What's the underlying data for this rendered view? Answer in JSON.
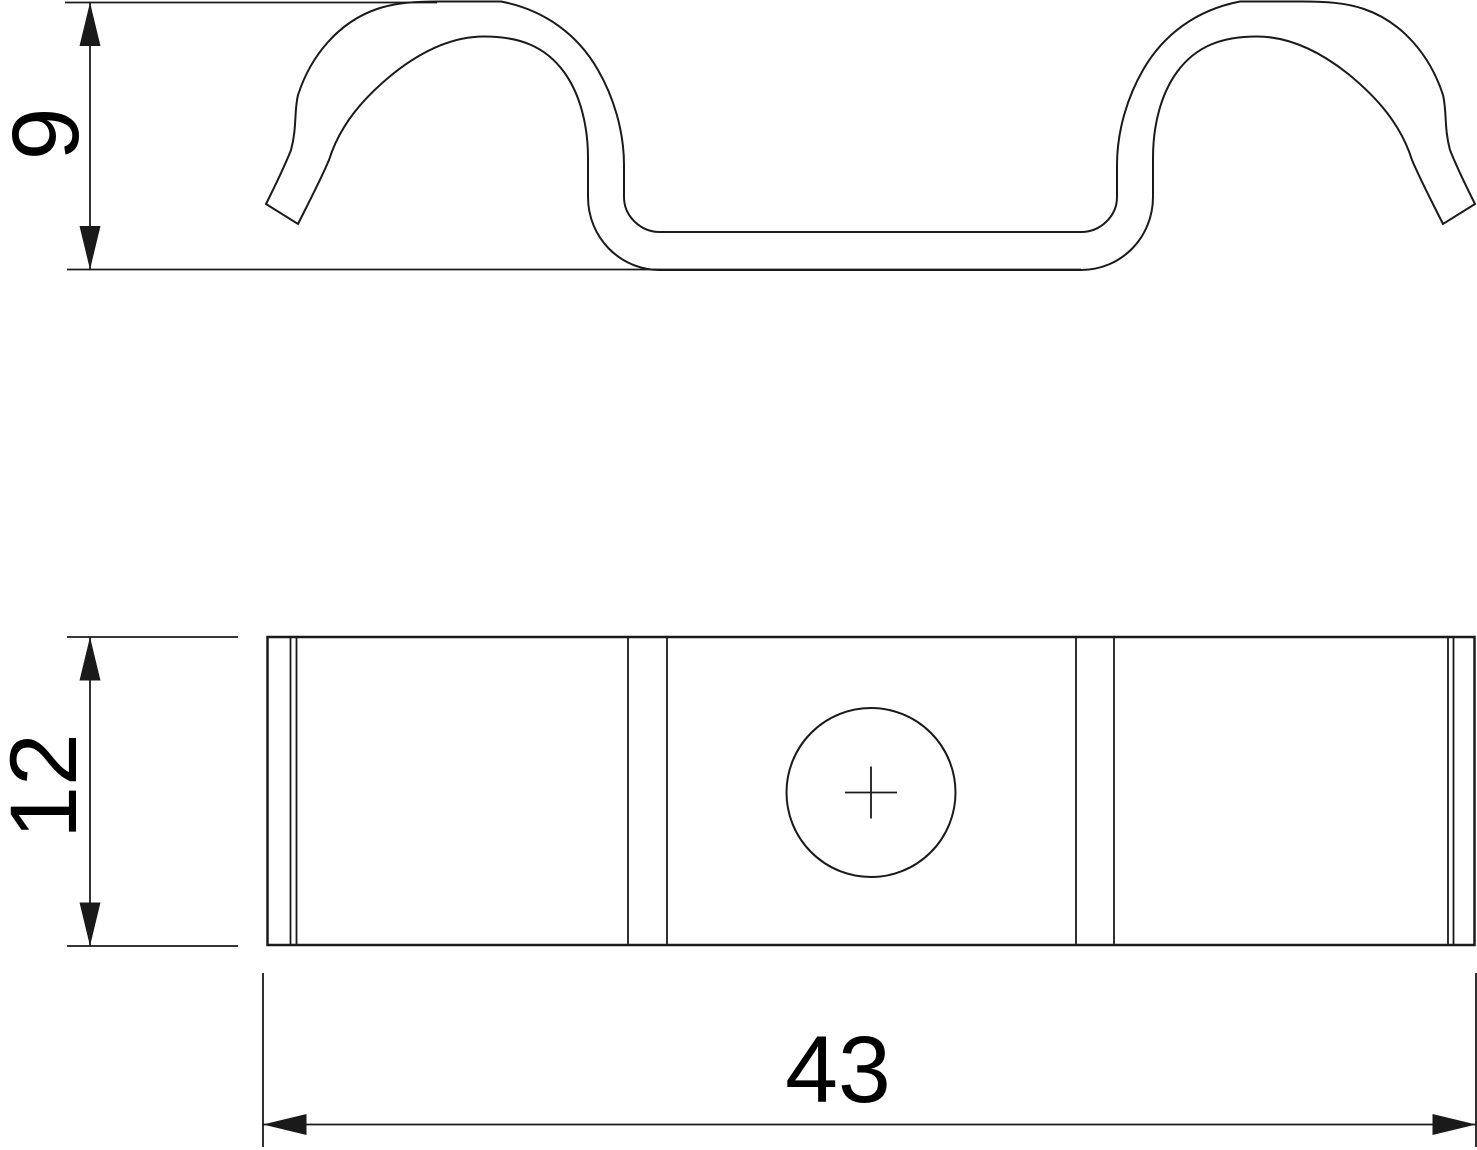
{
  "drawing": {
    "type": "technical-drawing-two-views",
    "colors": {
      "background": "#ffffff",
      "line": "#1a1a1a",
      "text": "#000000"
    },
    "side_view": {
      "description": "side profile of double-hump spring clip",
      "height_dim": {
        "value": "9"
      }
    },
    "plan_view": {
      "description": "plan view of clip plate with center hole",
      "height_dim": {
        "value": "12"
      },
      "width_dim": {
        "value": "43"
      }
    }
  }
}
